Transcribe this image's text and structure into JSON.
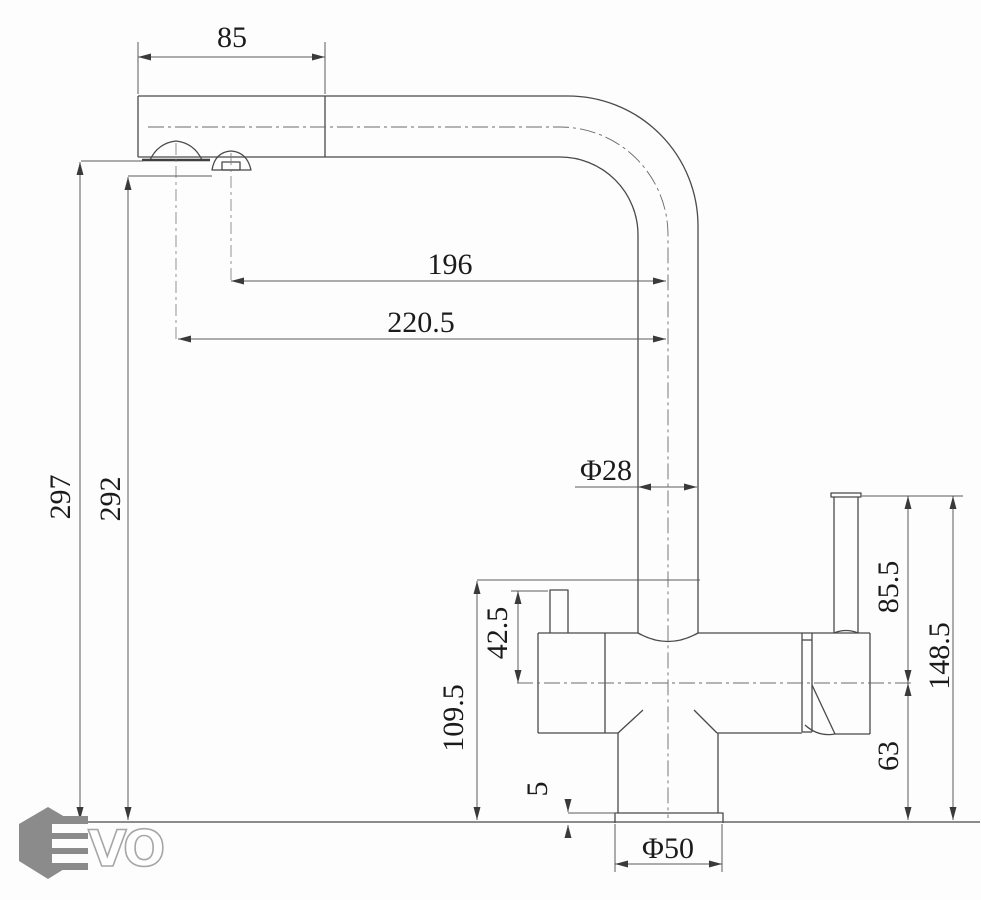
{
  "drawing": {
    "type": "kitchen-faucet-dimension-drawing",
    "line_color": "#4a4a4a",
    "background": "#fdfdfd"
  },
  "dims": {
    "d85": "85",
    "d196": "196",
    "d220_5": "220.5",
    "d297": "297",
    "d292": "292",
    "d_phi28": "Φ28",
    "d85_5": "85.5",
    "d148_5": "148.5",
    "d63": "63",
    "d42_5": "42.5",
    "d109_5": "109.5",
    "d5": "5",
    "d_phi50": "Φ50"
  },
  "logo": {
    "brand": "EVO",
    "vo": "VO",
    "hex_color": "#8b8b8b",
    "outline_color": "#a6a6a6"
  }
}
